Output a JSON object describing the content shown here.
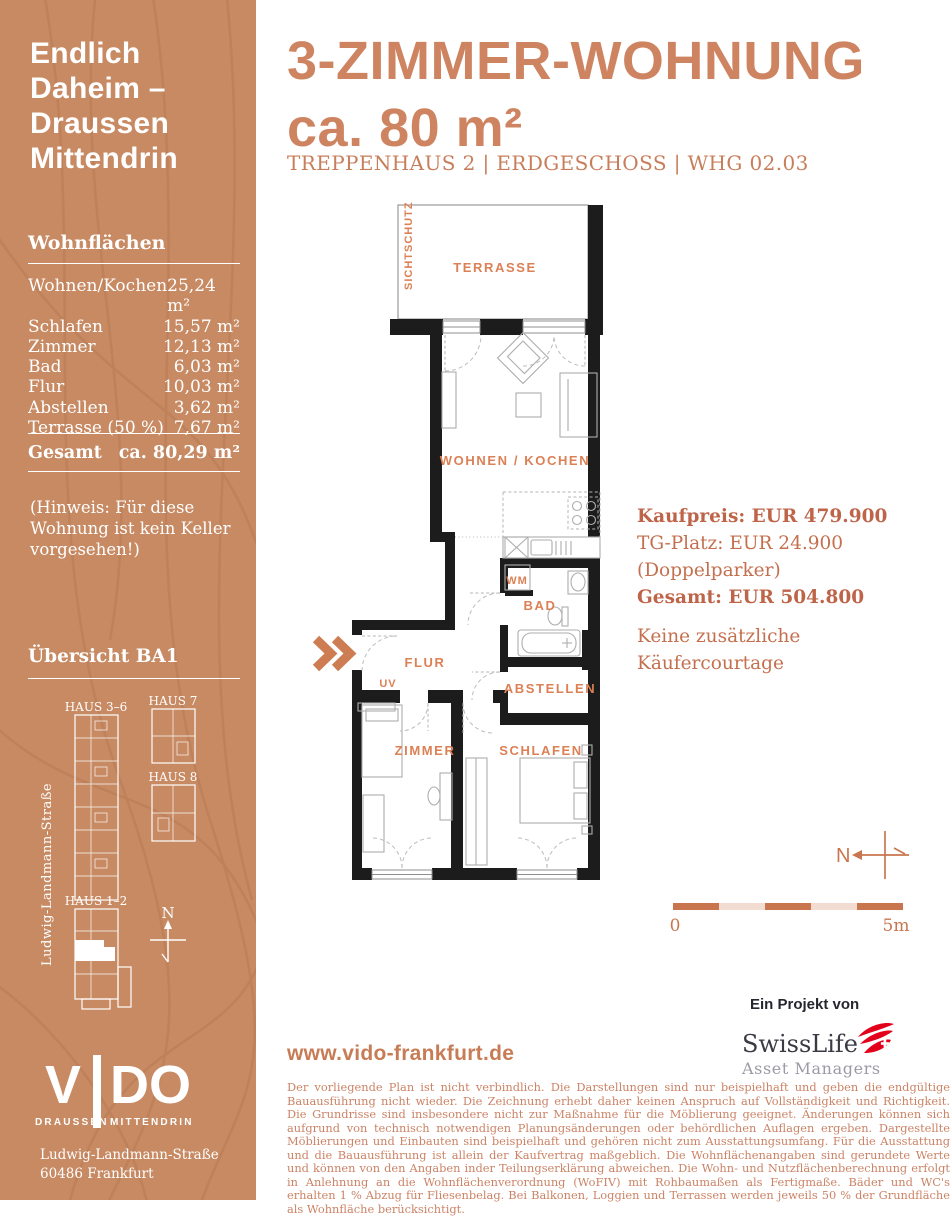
{
  "sidebar": {
    "headline_lines": [
      "Endlich",
      "Daheim –",
      "Draussen",
      "Mittendrin"
    ],
    "wohnflaechen": {
      "title": "Wohnflächen",
      "rows": [
        {
          "label": "Wohnen/Kochen",
          "value": "25,24 m²"
        },
        {
          "label": "Schlafen",
          "value": "15,57 m²"
        },
        {
          "label": "Zimmer",
          "value": "12,13 m²"
        },
        {
          "label": "Bad",
          "value": "6,03 m²"
        },
        {
          "label": "Flur",
          "value": "10,03 m²"
        },
        {
          "label": "Abstellen",
          "value": "3,62 m²"
        },
        {
          "label": "Terrasse (50 %)",
          "value": "7,67 m²"
        }
      ],
      "total_label": "Gesamt",
      "total_value": "ca. 80,29 m²"
    },
    "note": "(Hinweis: Für diese Wohnung ist kein Keller vorgesehen!)",
    "uebersicht": {
      "title": "Übersicht BA1",
      "buildings": [
        "HAUS 3–6",
        "HAUS 7",
        "HAUS 8",
        "HAUS 1–2"
      ],
      "street": "Ludwig-Landmann-Straße",
      "north_label": "N"
    },
    "logo": {
      "brand": "VIDO",
      "part1": "V",
      "part2": "DO",
      "tagline_left": "DRAUSSEN",
      "tagline_right": "MITTENDRIN"
    },
    "address": {
      "line1": "Ludwig-Landmann-Straße",
      "line2": "60486 Frankfurt"
    }
  },
  "header": {
    "title_line1": "3-ZIMMER-WOHNUNG",
    "title_line2": "ca. 80 m²",
    "subtitle": "TREPPENHAUS 2 | ERDGESCHOSS | WHG 02.03"
  },
  "floorplan": {
    "rooms": {
      "terrasse": "TERRASSE",
      "sichtschutz": "SICHTSCHUTZ",
      "wohnen_kochen": "WOHNEN / KOCHEN",
      "wm": "WM",
      "bad": "BAD",
      "flur": "FLUR",
      "uv": "UV",
      "abstellen": "ABSTELLEN",
      "zimmer": "ZIMMER",
      "schlafen": "SCHLAFEN"
    }
  },
  "pricing": {
    "kaufpreis": "Kaufpreis: EUR 479.900",
    "tg_platz": "TG-Platz: EUR 24.900 (Doppelparker)",
    "gesamt": "Gesamt: EUR 504.800",
    "courtage": "Keine zusätzliche Käufercourtage"
  },
  "scalebar": {
    "north": "N",
    "start": "0",
    "end": "5m"
  },
  "footer": {
    "project_label": "Ein Projekt von",
    "swisslife": {
      "name": "SwissLife",
      "sub": "Asset Managers"
    },
    "website": "www.vido-frankfurt.de",
    "disclaimer": "Der vorliegende Plan ist nicht verbindlich. Die Darstellungen sind nur beispielhaft und geben die endgültige Bauausführung nicht wieder. Die Zeichnung erhebt daher keinen Anspruch auf Vollständigkeit und Richtigkeit. Die Grundrisse sind insbesondere nicht zur Maßnahme für die Möblierung geeignet. Änderungen können sich aufgrund von technisch notwendigen Planungsänderungen oder behördlichen Auflagen ergeben. Dargestellte Möblierungen und Einbauten sind beispielhaft und gehören nicht zum Ausstattungsumfang. Für die Ausstattung und die Bauausführung ist allein der Kaufvertrag maßgeblich. Die Wohnflächenangaben sind gerundete Werte und können von den Angaben inder Teilungserklärung abweichen. Die Wohn- und Nutzflächenberechnung erfolgt in Anlehnung an die Wohnflächenverordnung (WoFIV) mit Rohbaumaßen als Fertigmaße. Bäder und WC's erhalten 1 % Abzug für Fliesenbelag. Bei Balkonen, Loggien und Terrassen werden jeweils 50 % der Grundfläche als Wohnfläche berücksichtigt."
  },
  "colors": {
    "sidebar_bg": "#c78a63",
    "title_orange": "#ce8460",
    "plan_label_orange": "#dc8055",
    "price_red": "#be6449",
    "swisslife_red": "#e2001a",
    "wall_black": "#1c1c1c"
  }
}
